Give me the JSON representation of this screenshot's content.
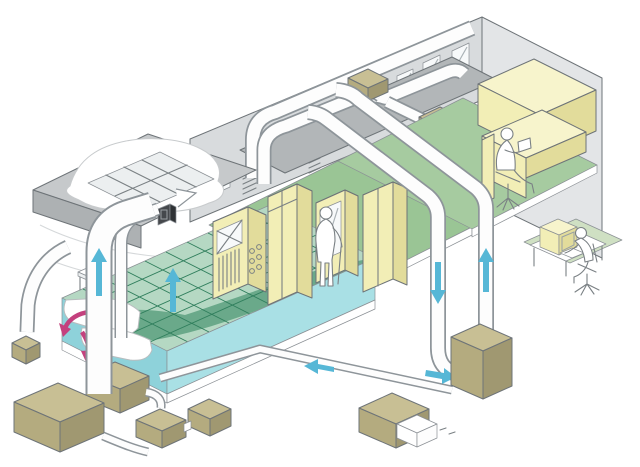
{
  "diagram": {
    "type": "isometric-cutaway-illustration",
    "subject": "building air-conditioning and airflow system",
    "rooms": [
      {
        "name": "machine-room",
        "features": [
          "raised access floor with green tile grid",
          "underfloor cool-air plenum (teal)",
          "ceiling plenum cutaway with tile grid",
          "small service table"
        ]
      },
      {
        "name": "equipment-room",
        "features": [
          "four yellow equipment cabinets",
          "control panel with gauges and vents",
          "glazed-door unit",
          "standing operator"
        ]
      },
      {
        "name": "office",
        "features": [
          "yellow counters and desk",
          "seated worker reading"
        ]
      }
    ],
    "equipment_units": [
      {
        "name": "rooftop-fan-unit-1"
      },
      {
        "name": "rooftop-fan-unit-2"
      },
      {
        "name": "outdoor-unit-small-left"
      },
      {
        "name": "outdoor-unit-large-left"
      },
      {
        "name": "outdoor-unit-mid-1"
      },
      {
        "name": "outdoor-unit-mid-2"
      },
      {
        "name": "outdoor-unit-mid-3"
      },
      {
        "name": "outdoor-unit-right-exhaust"
      },
      {
        "name": "air-handling-unit-tall"
      }
    ],
    "airflow_arrows": [
      {
        "name": "left-riser-up",
        "direction": "up",
        "color_role": "supply"
      },
      {
        "name": "plenum-inlet",
        "direction": "up-right",
        "color_role": "duct-outline"
      },
      {
        "name": "floor-edge-up",
        "direction": "up",
        "color_role": "supply"
      },
      {
        "name": "underfloor-swirl-1",
        "direction": "down-left",
        "color_role": "underfloor"
      },
      {
        "name": "underfloor-swirl-2",
        "direction": "down",
        "color_role": "underfloor"
      },
      {
        "name": "return-duct-down",
        "direction": "down",
        "color_role": "supply"
      },
      {
        "name": "riser-duct-up",
        "direction": "up",
        "color_role": "supply"
      },
      {
        "name": "ahu-inlet-right",
        "direction": "right",
        "color_role": "supply"
      },
      {
        "name": "ground-duct-left",
        "direction": "left",
        "color_role": "supply"
      }
    ],
    "people": [
      {
        "name": "standing-operator",
        "location": "equipment-room"
      },
      {
        "name": "seated-office-worker",
        "location": "office"
      },
      {
        "name": "monitoring-operator",
        "location": "outside at computer desk"
      }
    ]
  },
  "colors": {
    "bg": "#ffffff",
    "wallBack": "#d8dbdd",
    "wallRight": "#e3e5e7",
    "roofMid": "#b2b6b8",
    "roofLeftTop": "#c6c9cb",
    "roofLeftFront": "#adb1b3",
    "tilePatch": "#eceff0",
    "windowFill": "#f7f9fa",
    "floorGreen": "#9ac595",
    "floorGreenLight": "#a6cba0",
    "matGreen": "#cfe0c3",
    "gridGreen": "#b5d8c3",
    "gridGreenDark": "#6aa98a",
    "teal": "#8ed2da",
    "tealLight": "#a9e0e5",
    "yellow": "#f2eeb6",
    "yellowLight": "#f7f4cc",
    "yellowDark": "#e2dc9b",
    "khakiTop": "#c8bf94",
    "khakiFront": "#b4ab7f",
    "khakiSide": "#a09871",
    "ductFill": "#fdfdfd",
    "darkBox": "#45484c",
    "darkBoxSide": "#2f3235",
    "arrowCyan": "#56b7d6",
    "arrowPink": "#c4417e",
    "white": "#ffffff"
  }
}
